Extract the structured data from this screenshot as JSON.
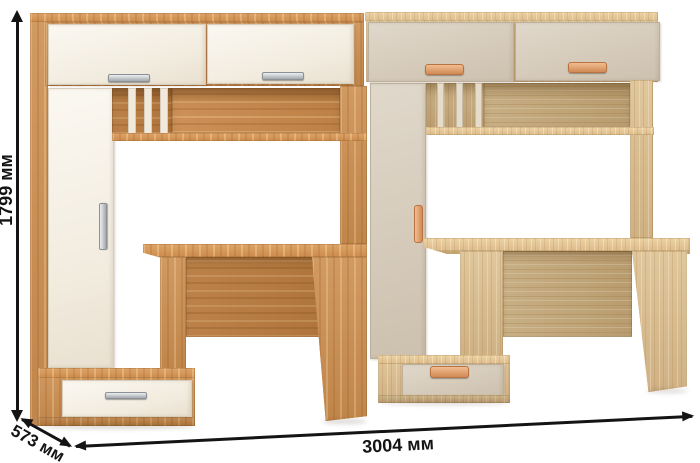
{
  "dimension_labels": {
    "height": "1799 мм",
    "depth": "573 мм",
    "width": "3004 мм"
  },
  "colors": {
    "background": "#ffffff",
    "annotation": "#141414",
    "left_unit_wood": "#c9905a",
    "left_unit_fronts": "#f6f1e8",
    "left_unit_handles": "#b5babe",
    "right_unit_wood": "#d9bf94",
    "right_unit_fronts": "#d7cdbd",
    "right_unit_handles": "#de9a6b"
  },
  "units": [
    {
      "position": "left",
      "finish": "golden craft oak body with white fronts",
      "handle_type": "metal bar handles"
    },
    {
      "position": "right",
      "finish": "light oak body with beige fronts",
      "handle_type": "wooden bracket handles"
    }
  ]
}
